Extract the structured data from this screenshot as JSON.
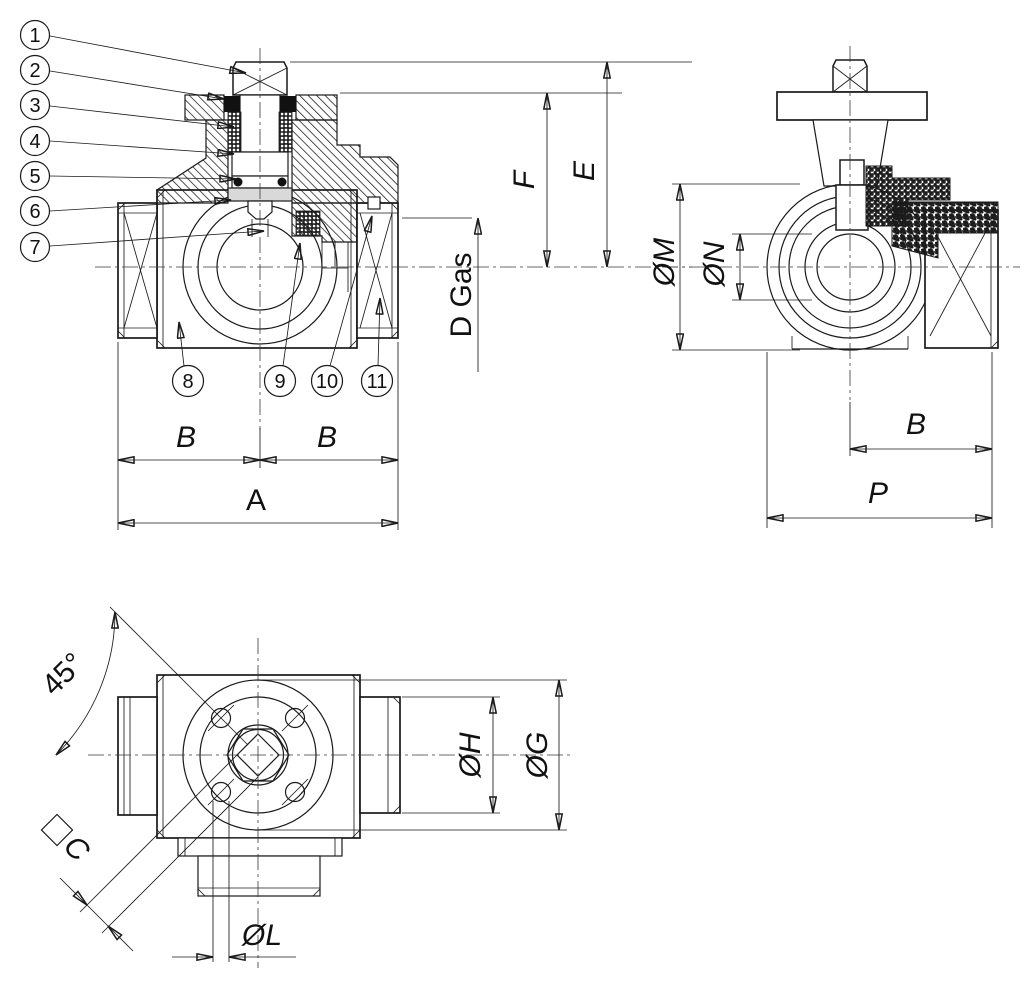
{
  "colors": {
    "line": "#1a1a1a",
    "background": "#ffffff"
  },
  "callouts": [
    "1",
    "2",
    "3",
    "4",
    "5",
    "6",
    "7",
    "8",
    "9",
    "10",
    "11"
  ],
  "front_view": {
    "dim_b_left": "B",
    "dim_b_right": "B",
    "dim_a": "A",
    "dim_f": "F",
    "dim_e": "E",
    "dim_d_gas": "D Gas"
  },
  "side_view": {
    "dim_m": "ØM",
    "dim_n": "ØN",
    "dim_b": "B",
    "dim_p": "P"
  },
  "top_view": {
    "dim_angle": "45°",
    "dim_c": "C",
    "dim_l": "ØL",
    "dim_h": "ØH",
    "dim_g": "ØG"
  }
}
